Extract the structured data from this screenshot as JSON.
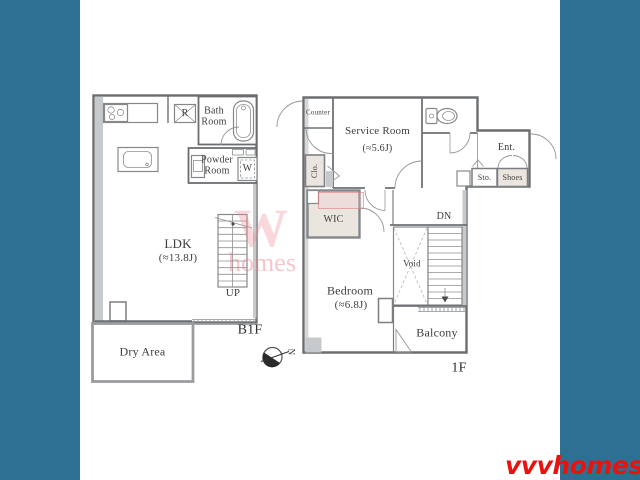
{
  "floors": {
    "b1f": {
      "floor_label": "B1F",
      "ldk_name": "LDK",
      "ldk_size": "(≈13.8J)",
      "bath_line1": "Bath",
      "bath_line2": "Room",
      "powder_line1": "Powder",
      "powder_line2": "Room",
      "refrigerator": "R",
      "washer": "W",
      "stairs_up": "UP",
      "dry_area": "Dry Area"
    },
    "f1": {
      "floor_label": "1F",
      "counter": "Counter",
      "service_name": "Service Room",
      "service_size": "(≈5.6J)",
      "closet": "Clo.",
      "entrance": "Ent.",
      "storage": "Sto.",
      "shoes": "Shoes",
      "wic": "WIC",
      "stairs_down": "DN",
      "void": "Void",
      "bedroom_name": "Bedroom",
      "bedroom_size": "(≈6.8J)",
      "balcony": "Balcony"
    }
  },
  "compass": {
    "north": "N"
  },
  "brand": {
    "logo": "vvvhomes",
    "watermark_big": "W",
    "watermark_small": "homes"
  },
  "colors": {
    "background": "#2e7093",
    "wall": "#6f7275",
    "accent_red": "#e8130e",
    "beige": "#eae5df"
  }
}
